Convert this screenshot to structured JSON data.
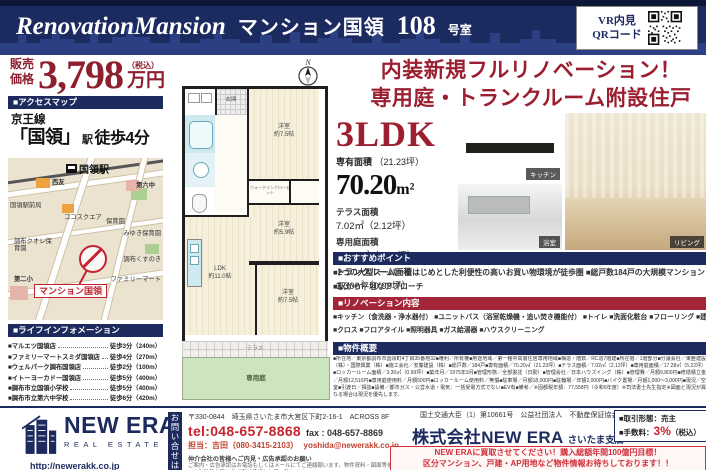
{
  "header": {
    "title_en": "RenovationMansion",
    "title_jp": "マンション国領",
    "room_no": "108",
    "room_suffix": "号室",
    "vr_line1": "VR内見",
    "vr_line2": "QRコード"
  },
  "price": {
    "label_line1": "販売",
    "label_line2": "価格",
    "amount": "3,798",
    "tax_note": "（税込）",
    "unit": "万円"
  },
  "access": {
    "section_title": "■アクセスマップ",
    "line_name": "京王線",
    "station": "「国領」",
    "station_suffix": "駅",
    "walk": "徒歩4分"
  },
  "map": {
    "station": "国領駅",
    "marker_label": "マンション国領",
    "labels": [
      "西友",
      "ココスクエア",
      "国領駅前局",
      "調布クオレ保育園",
      "第六中",
      "保育園",
      "みゆき保育園",
      "調布くすのき",
      "ファミリーマート",
      "第二小"
    ]
  },
  "life": {
    "section_title": "■ライフインフォメーション",
    "items": [
      {
        "name": "■マルエツ国領店",
        "value": "徒歩3分（240m）"
      },
      {
        "name": "■ファミリーマートスミダ国領店",
        "value": "徒歩4分（270m）"
      },
      {
        "name": "■ウェルパーク調布国領店",
        "value": "徒歩2分（100m）"
      },
      {
        "name": "■イトーヨーカドー国領店",
        "value": "徒歩5分（400m）"
      },
      {
        "name": "■調布市立国領小学校",
        "value": "徒歩5分（400m）"
      },
      {
        "name": "■調布市立第六中学校",
        "value": "徒歩6分（420m）"
      }
    ]
  },
  "highlight": {
    "line1": "内装新規フルリノベーション！",
    "line2": "専用庭・トランクルーム附設住戸"
  },
  "unit": {
    "layout": "3LDK",
    "area_label": "専有面積",
    "area_tsubo": "（21.23坪）",
    "area_value": "70.20",
    "area_unit": "m²",
    "details": [
      {
        "label": "テラス面積",
        "value": "7.02㎡（2.12坪）"
      },
      {
        "label": "専用庭面積",
        "value": "17.28㎡（5.22坪）"
      },
      {
        "label": "トランクルーム面積",
        "value": "3.30㎡（0.99坪）"
      }
    ]
  },
  "photos": [
    {
      "label": "キッチン"
    },
    {
      "label": "浴室"
    },
    {
      "label": "リビング"
    }
  ],
  "floorplan": {
    "compass": "N",
    "genkan": "玄関",
    "wic": "ウォークインクローゼット",
    "rooms": [
      {
        "name": "洋室",
        "size": "約7.5帖"
      },
      {
        "name": "洋室",
        "size": "約5.9帖"
      },
      {
        "name": "洋室",
        "size": "約7.5帖"
      },
      {
        "name": "LDK",
        "size": "約11.0帖"
      }
    ],
    "terrace": "テラス",
    "garden": "専用庭"
  },
  "points": {
    "section_title": "■おすすめポイント",
    "line1": "■2つの大型スーパーをはじめとした利便性の高いお買い物環境が徒歩圏 ■総戸数184戸の大規模マンション",
    "line2": "■駅から平坦なアプローチ"
  },
  "renovation": {
    "section_title": "■リノベーション内容",
    "line1": "■キッチン（食洗器・浄水器付） ■ユニットバス（浴室乾燥機・追い焚き機能付） ■トイレ ■洗面化粧台 ■フローリング ■建具",
    "line2": "■クロス ■フロアタイル ■照明器具 ■ガス給湯器 ■ハウスクリーニング"
  },
  "overview": {
    "section_title": "■物件概要",
    "text": "■所在地／東京都調布市国領町4丁目35番地32■権利／所有権■用途地域／第一種中高層住居専用地域■構造・階数／RC造7階建■所在階／1階部分■分譲会社／東亜建設（株）・国際興業（株）■施工会社／安藤建設（株）■総戸数／184戸■専有面積／70.20㎡（21.23坪）■テラス面積／7.02㎡（2.12坪）■専用庭面積／17.28㎡（5.22坪）■ロッカールーム面積／3.30㎡（0.99坪）■築年月／1975年3月■管理形態／全部委託（日勤）■管理会社／日本ハウズイング（株）■管理費／月額9,800円■修繕積立金／月額12,510円■専用庭使用料／月額500円■ロッカールーム使用料／無償■駐車場／月額18,000円■駐輪場／年額2,000円■バイク置場／月額1,000～3,000円■現況／空室■引渡日／相談■設備／都市ガス・公営水道・電気：一括受電方式でない■EV有■備考／※固都税年額：77,558円（令和6年度）※司法書士先生指定※図面と現況が異なる場合は現況を優先します。"
  },
  "footer": {
    "address": "〒330-0844　埼玉県さいたま市大宮区下町2-16-1　ACROSS 8F",
    "tel": "tel:048-657-8868",
    "fax": "fax : 048-657-8869",
    "person": "担当：吉田（080-3415-2103）",
    "email": "yoshida@newerakk.co.jp",
    "notice_title": "仲介会社の皆様へご内見・広告承認のお願い",
    "notice_line1": "ご案内・広告承認はお電話もしくはメールにてご連絡願います。物件資料・図面等をお送り致します。",
    "notice_line2": "※広告掲載の際は必ず事前承認をお願い致します。",
    "vertical_label": "お問い合せは",
    "logo_name": "NEW ERA",
    "logo_sub": "REAL ESTATE",
    "url": "http://newerakk.co.jp",
    "license": "国土交通大臣（1）第10661号　公益社団法人　不動産保証協会",
    "company": "株式会社NEW ERA",
    "branch": "さいたま支店",
    "deal_label": "■取引形態：",
    "deal_value": "売主",
    "fee_label": "■手数料：",
    "fee_value": "3%",
    "fee_note": "（税込）",
    "banner_line1": "NEW ERAに買取させてください！購入総額年間100億円目標！",
    "banner_line2": "区分マンション、戸建・AP用地など物件情報お待ちしております！！"
  }
}
